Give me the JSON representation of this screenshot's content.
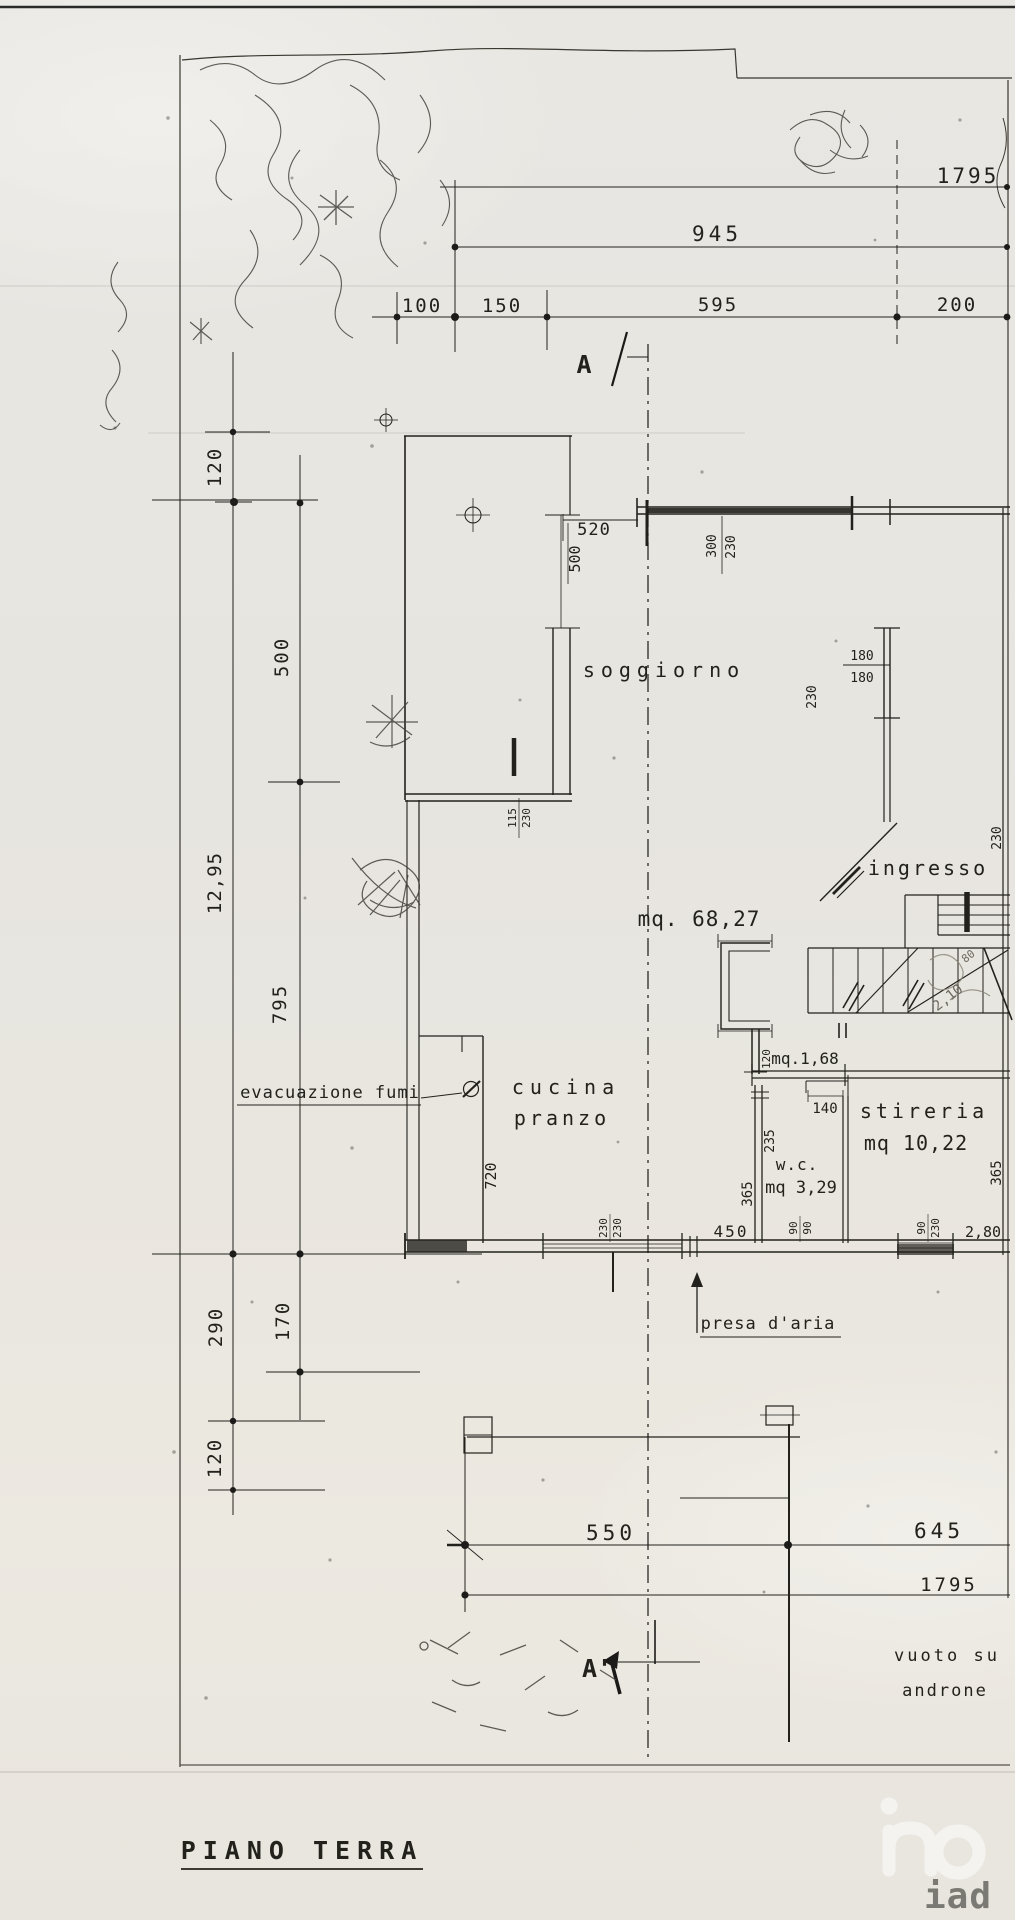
{
  "drawing": {
    "title": "PIANO TERRA"
  },
  "rooms": {
    "soggiorno": {
      "label": "soggiorno",
      "area": "mq. 68,27"
    },
    "ingresso": {
      "label": "ingresso"
    },
    "cucina": {
      "label": "cucina"
    },
    "pranzo": {
      "label": "pranzo"
    },
    "wc": {
      "label": "w.c.",
      "area": "mq 3,29"
    },
    "stireria": {
      "label": "stireria",
      "area": "mq 10,22"
    },
    "shaft": {
      "area": "mq.1,68"
    }
  },
  "annotations": {
    "evacuazione_fumi": "evacuazione fumi",
    "presa_daria": "presa d'aria",
    "vuoto_su_line1": "vuoto su",
    "vuoto_su_line2": "androne",
    "section_start": "A",
    "section_end": "A'",
    "pencil_note_1": "2,10",
    "pencil_note_2": "80"
  },
  "dimensions": {
    "top": {
      "total": "1795",
      "upper": "945",
      "seg_100": "100",
      "seg_150": "150",
      "seg_595": "595",
      "seg_200": "200"
    },
    "left": {
      "seg_120_upper": "120",
      "seg_500": "500",
      "total": "12,95",
      "seg_795": "795",
      "seg_290": "290",
      "seg_170": "170",
      "seg_120_lower": "120"
    },
    "bottom": {
      "seg_550": "550",
      "seg_645": "645",
      "total": "1795"
    },
    "plan": {
      "w520": "520",
      "h500": "500",
      "w300": "300",
      "h230_top": "230",
      "w115": "115",
      "h230_door": "230",
      "win180_a": "180",
      "win180_b": "180",
      "h230_wall": "230",
      "h230_entry": "230",
      "h720": "720",
      "w120_shaft": "120",
      "h235": "235",
      "h365_wc": "365",
      "w140": "140",
      "w450": "450",
      "w230_win_a": "230",
      "h230_win_a": "230",
      "w90_a": "90",
      "h90_b": "90",
      "w90_c": "90",
      "h230_win_b": "230",
      "h365_stireria": "365",
      "w280": "2,80"
    }
  },
  "watermark": {
    "logo": "iad"
  },
  "colors": {
    "paper": "#e8e6e1",
    "ink": "#22201c",
    "pencil": "#6e6a62",
    "watermark": "#ffffff"
  }
}
